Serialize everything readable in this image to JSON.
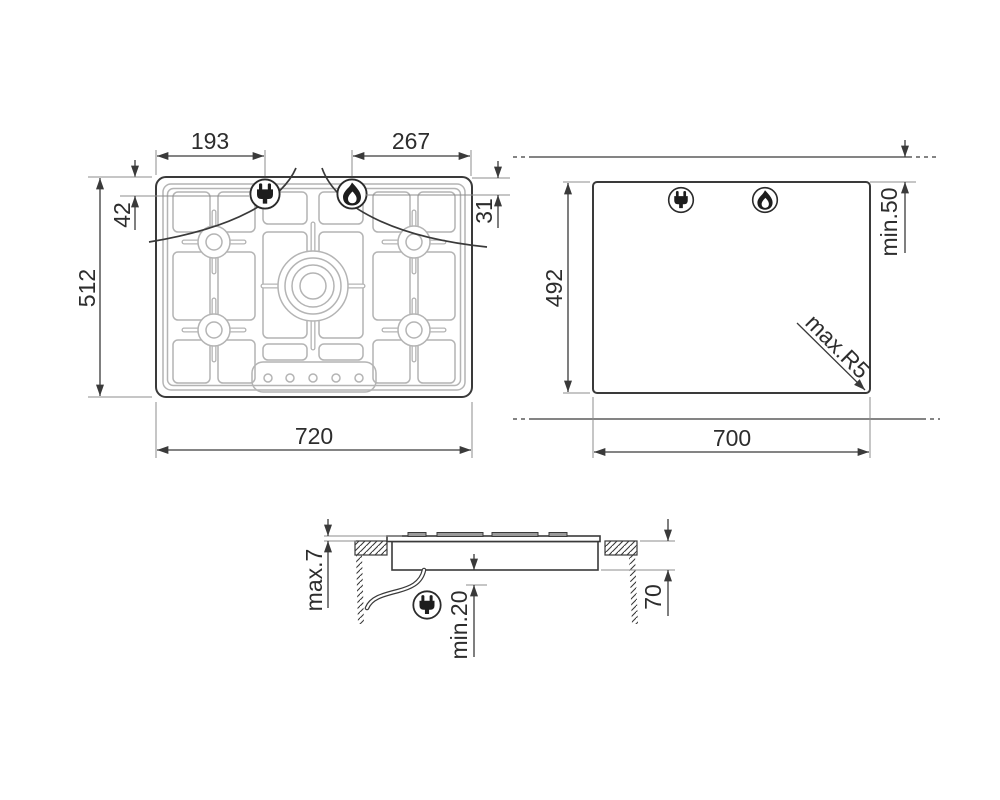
{
  "top_view": {
    "width": "720",
    "depth": "512",
    "electrical_offset": "193",
    "gas_offset": "267",
    "electrical_inset": "42",
    "gas_inset": "31"
  },
  "cutout_view": {
    "width": "700",
    "depth": "492",
    "wall_clearance": "min.50",
    "corner_radius": "max.R5"
  },
  "side_view": {
    "rim_height": "max.7",
    "clearance_below": "min.20",
    "worktop_recess": "70"
  },
  "icons": {
    "electrical": "plug-icon",
    "gas": "flame-icon"
  },
  "colors": {
    "line": "#3a3a3a",
    "detail_line": "#b4b4b4",
    "background": "#ffffff"
  }
}
